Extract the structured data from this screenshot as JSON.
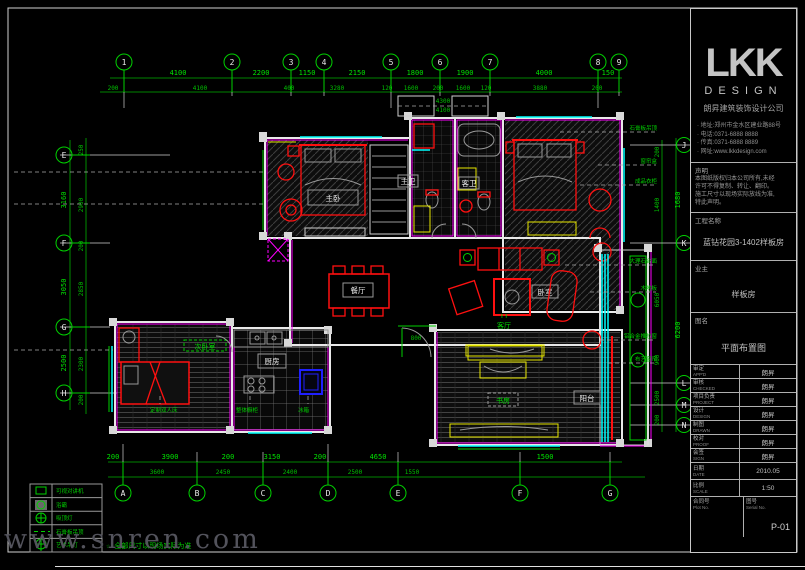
{
  "sheet": {
    "watermark": "www.snren.com",
    "note": "☆-全部尺寸以现场实际为准"
  },
  "grid": {
    "top": [
      "1",
      "2",
      "3",
      "4",
      "5",
      "6",
      "7",
      "8",
      "9"
    ],
    "bottom": [
      "A",
      "B",
      "C",
      "D",
      "E",
      "F",
      "G"
    ],
    "left": [
      "E",
      "F",
      "G",
      "H"
    ],
    "right": [
      "J",
      "K",
      "L",
      "M",
      "N"
    ]
  },
  "dims": {
    "top1": [
      "4100",
      "2200",
      "1150",
      "2150",
      "1800",
      "1900",
      "4000",
      "150"
    ],
    "top2": [
      "200",
      "4100",
      "400",
      "3280",
      "120",
      "1600",
      "200",
      "1600",
      "120",
      "3880",
      "200"
    ],
    "bottom1": [
      "200",
      "3900",
      "200",
      "3150",
      "200",
      "4650",
      "1500"
    ],
    "bottom2": [
      "3600",
      "2450",
      "2400",
      "2500",
      "1550"
    ],
    "left_outer": [
      "3160",
      "3050",
      "2500"
    ],
    "left_inner": [
      "250",
      "2900",
      "200",
      "2850",
      "2300",
      "200"
    ],
    "right_outer": [
      "1680",
      "6200"
    ],
    "right_inner": [
      "200",
      "1400",
      "6050",
      "900",
      "2500",
      "200"
    ],
    "inner": [
      "4300",
      "4100",
      "800"
    ]
  },
  "rooms": [
    {
      "label": "主卧"
    },
    {
      "label": "主卫"
    },
    {
      "label": "客卫"
    },
    {
      "label": "卧室"
    },
    {
      "label": "客厅"
    },
    {
      "label": "餐厅"
    },
    {
      "label": "厨房"
    },
    {
      "label": "次卧室"
    },
    {
      "label": "书房"
    },
    {
      "label": "阳台"
    }
  ],
  "living_arrows": "↑↑",
  "annotations": [
    "石膏板吊顶",
    "窗帘盒",
    "成品衣柜",
    "大理石台面",
    "木地板",
    "铝合金推拉窗",
    "布艺窗帘",
    "定制双人床",
    "整体橱柜",
    "冰箱"
  ],
  "legend": {
    "rows": [
      {
        "label": "可视对讲机"
      },
      {
        "label": "浴霸"
      },
      {
        "label": "吸顶灯"
      },
      {
        "label": "石膏板吊顶"
      },
      {
        "label": "艺术吊灯"
      }
    ]
  },
  "title_block": {
    "logo": "LKK",
    "logo_sub": "DESIGN",
    "company": "朗昇建筑装饰设计公司",
    "contacts": [
      "· 地址:郑州市金水区建业路88号",
      "· 电话:0371-6888 8888",
      "· 传真:0371-6888 8889",
      "· 网址:www.lkkdesign.com"
    ],
    "notice_label": "声明",
    "notice_lines": [
      "本图纸版权归本公司所有,未经",
      "许可不得复制、转让、翻印。",
      "施工尺寸以现场实际放线为准,",
      "特此声明。"
    ],
    "project_label": "工程名称",
    "project_value": "蓝钻花园3-1402样板房",
    "client_label": "业主",
    "client_value": "样板房",
    "drawing_label": "图名",
    "drawing_value": "平面布置图",
    "table": [
      {
        "label": "审定",
        "en": "APP'D",
        "value": "朗昇"
      },
      {
        "label": "审核",
        "en": "CHECKED",
        "value": "朗昇"
      },
      {
        "label": "项目负责",
        "en": "PROJECT",
        "value": "朗昇"
      },
      {
        "label": "设计",
        "en": "DESIGN",
        "value": "朗昇"
      },
      {
        "label": "制图",
        "en": "DRAWN",
        "value": "朗昇"
      },
      {
        "label": "校对",
        "en": "PROOF",
        "value": "朗昇"
      },
      {
        "label": "会签",
        "en": "SIGN",
        "value": "朗昇"
      }
    ],
    "date_label": "日期",
    "date_en": "DATE",
    "date_value": "2010.05",
    "scale_label": "比例",
    "scale_en": "SCALE",
    "scale_value": "1:50",
    "plot_label": "合同号",
    "plot_en": "Plot No.",
    "serial_label": "图号",
    "serial_en": "Serial No.",
    "page": "P-01"
  }
}
